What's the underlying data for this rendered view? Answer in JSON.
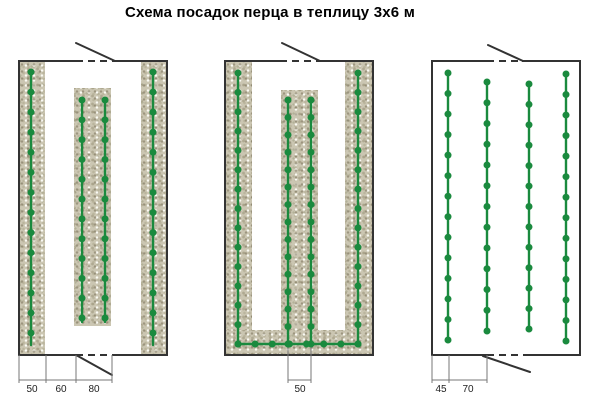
{
  "title": "Схема посадок перца в теплицу 3х6 м",
  "colors": {
    "plant": "#1a8a3e",
    "bed_base": "#cbc6b2",
    "frame": "#333333",
    "dim_line": "#777777",
    "dim_text": "#222222",
    "background": "#ffffff"
  },
  "diagrams": [
    {
      "id": "scheme-1",
      "frame": {
        "x": 19,
        "y": 61,
        "w": 148,
        "h": 294
      },
      "beds": [
        {
          "x": 19,
          "y": 61,
          "w": 26,
          "h": 294
        },
        {
          "x": 74,
          "y": 88,
          "w": 37,
          "h": 238
        },
        {
          "x": 141,
          "y": 61,
          "w": 26,
          "h": 294
        }
      ],
      "doors": [
        {
          "side": "top",
          "open_from": 76,
          "open_to": 113,
          "leaf": {
            "x1": 76,
            "y1": 43,
            "x2": 115,
            "y2": 61
          }
        },
        {
          "side": "bottom",
          "open_from": 76,
          "open_to": 112,
          "leaf": {
            "x1": 76,
            "y1": 355,
            "x2": 112,
            "y2": 375
          }
        }
      ],
      "plant_rows": [
        {
          "dir": "v",
          "pos": 31,
          "from": 72,
          "to": 333,
          "dots": 14,
          "tail": 12
        },
        {
          "dir": "v",
          "pos": 82,
          "from": 100,
          "to": 318,
          "dots": 12,
          "tail": 4
        },
        {
          "dir": "v",
          "pos": 105,
          "from": 100,
          "to": 318,
          "dots": 12,
          "tail": 4
        },
        {
          "dir": "v",
          "pos": 153,
          "from": 72,
          "to": 333,
          "dots": 14,
          "tail": 12
        }
      ],
      "dims": {
        "ticks": [
          19,
          46,
          76,
          112
        ],
        "tick_from": 355,
        "tick_to": 383,
        "baseline_y": 380,
        "baseline_from": 19,
        "baseline_to": 112,
        "labels": [
          {
            "text": "50",
            "x": 32
          },
          {
            "text": "60",
            "x": 61
          },
          {
            "text": "80",
            "x": 94
          }
        ],
        "label_y": 392
      }
    },
    {
      "id": "scheme-2",
      "frame": {
        "x": 225,
        "y": 61,
        "w": 148,
        "h": 294
      },
      "beds": [
        {
          "x": 225,
          "y": 61,
          "w": 27,
          "h": 294
        },
        {
          "x": 281,
          "y": 90,
          "w": 37,
          "h": 265
        },
        {
          "x": 345,
          "y": 61,
          "w": 28,
          "h": 294
        },
        {
          "x": 225,
          "y": 330,
          "w": 148,
          "h": 25
        }
      ],
      "doors": [
        {
          "side": "top",
          "open_from": 280,
          "open_to": 317,
          "leaf": {
            "x1": 282,
            "y1": 43,
            "x2": 320,
            "y2": 61
          }
        }
      ],
      "plant_rows": [
        {
          "dir": "v",
          "pos": 238,
          "from": 73,
          "to": 344,
          "dots": 15,
          "tail": 0
        },
        {
          "dir": "v",
          "pos": 288,
          "from": 100,
          "to": 344,
          "dots": 15,
          "tail": 0
        },
        {
          "dir": "v",
          "pos": 311,
          "from": 100,
          "to": 344,
          "dots": 15,
          "tail": 0
        },
        {
          "dir": "v",
          "pos": 358,
          "from": 73,
          "to": 344,
          "dots": 15,
          "tail": 0
        },
        {
          "dir": "h",
          "pos": 344,
          "from": 238,
          "to": 358,
          "dots": 8,
          "tail": 0
        }
      ],
      "dims": {
        "ticks": [
          288,
          311
        ],
        "tick_from": 328,
        "tick_to": 383,
        "baseline_y": 380,
        "baseline_from": 288,
        "baseline_to": 311,
        "labels": [
          {
            "text": "50",
            "x": 300
          }
        ],
        "label_y": 392
      }
    },
    {
      "id": "scheme-3",
      "frame": {
        "x": 432,
        "y": 61,
        "w": 148,
        "h": 294
      },
      "beds": [],
      "doors": [
        {
          "side": "top",
          "open_from": 487,
          "open_to": 522,
          "leaf": {
            "x1": 488,
            "y1": 45,
            "x2": 523,
            "y2": 61
          }
        },
        {
          "side": "bottom",
          "open_from": 487,
          "open_to": 527,
          "leaf": {
            "x1": 483,
            "y1": 356,
            "x2": 530,
            "y2": 372
          }
        }
      ],
      "plant_rows": [
        {
          "dir": "v",
          "pos": 448,
          "from": 73,
          "to": 340,
          "dots": 14,
          "tail": 0
        },
        {
          "dir": "v",
          "pos": 487,
          "from": 82,
          "to": 331,
          "dots": 13,
          "tail": 0
        },
        {
          "dir": "v",
          "pos": 529,
          "from": 84,
          "to": 329,
          "dots": 13,
          "tail": 0
        },
        {
          "dir": "v",
          "pos": 566,
          "from": 74,
          "to": 341,
          "dots": 14,
          "tail": 0
        }
      ],
      "dims": {
        "ticks": [
          432,
          449,
          487
        ],
        "tick_from": 355,
        "tick_to": 383,
        "baseline_y": 380,
        "baseline_from": 432,
        "baseline_to": 487,
        "labels": [
          {
            "text": "45",
            "x": 441
          },
          {
            "text": "70",
            "x": 468
          }
        ],
        "label_y": 392
      }
    }
  ]
}
